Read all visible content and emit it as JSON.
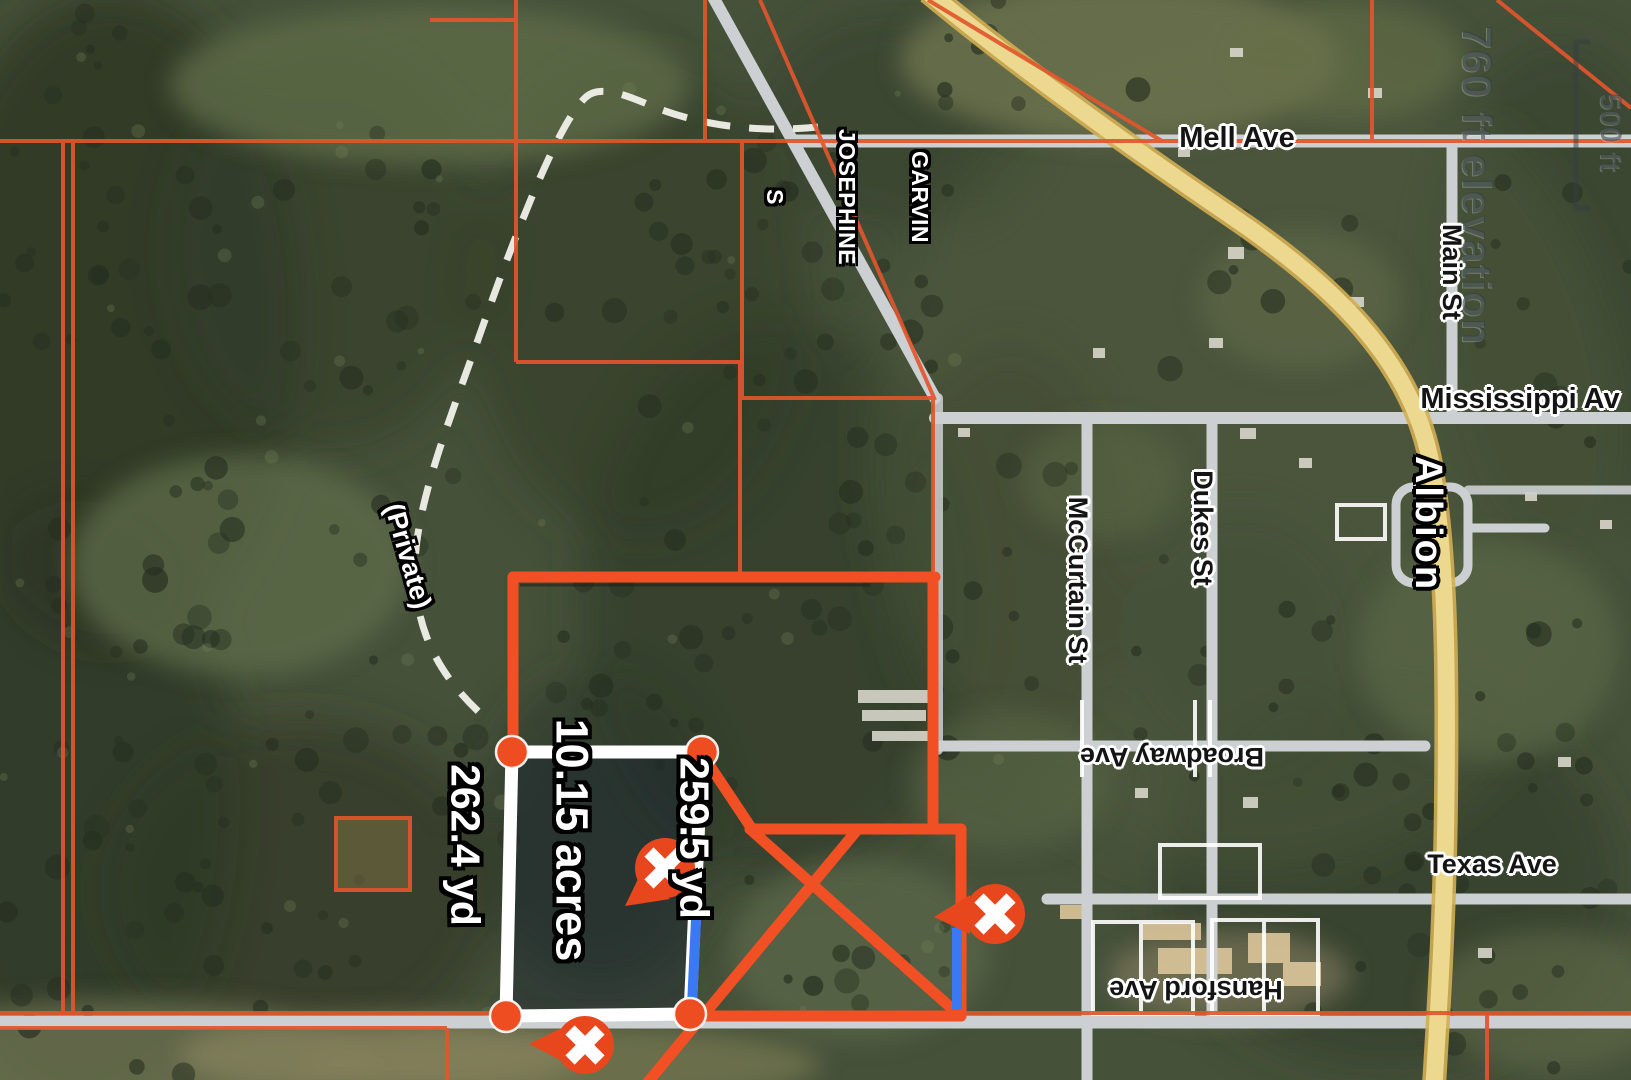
{
  "map": {
    "labels": {
      "mell_ave": "Mell Ave",
      "main_st": "Main St",
      "mississippi_ave": "Mississippi Av",
      "albion": "Albion",
      "dukes_st": "Dukes St",
      "mccurtain_st": "McCurtain St",
      "broadway_ave": "Broadway Ave",
      "texas_ave": "Texas Ave",
      "hansford_ave": "Hansford Ave",
      "private_road": "(Private)",
      "parcel_owner": {
        "line1": "GARVIN",
        "line2": "JOSEPHINE",
        "line3": "S"
      }
    },
    "measurement": {
      "left_side": "262.4 yd",
      "right_side": "259.5 yd",
      "area": "10.15 acres",
      "vertex_count": 4
    },
    "markers": [
      {
        "id": "parcel-center-marker",
        "icon": "x-circle-pin"
      },
      {
        "id": "south-vertex-marker",
        "icon": "x-circle-pin"
      },
      {
        "id": "east-boundary-marker",
        "icon": "x-circle-pin"
      }
    ],
    "watermark": {
      "elevation": "760 ft elevation"
    },
    "scale_bar": {
      "label": "500 ft"
    },
    "colors": {
      "parcel_line": "#e1562d",
      "selected_boundary": "#f14f24",
      "measure_outline": "#ffffff",
      "measured_segment": "#3b79f2",
      "marker": "#e8471e",
      "highway": "#ecd88f",
      "road": "#ccd0d2"
    }
  }
}
